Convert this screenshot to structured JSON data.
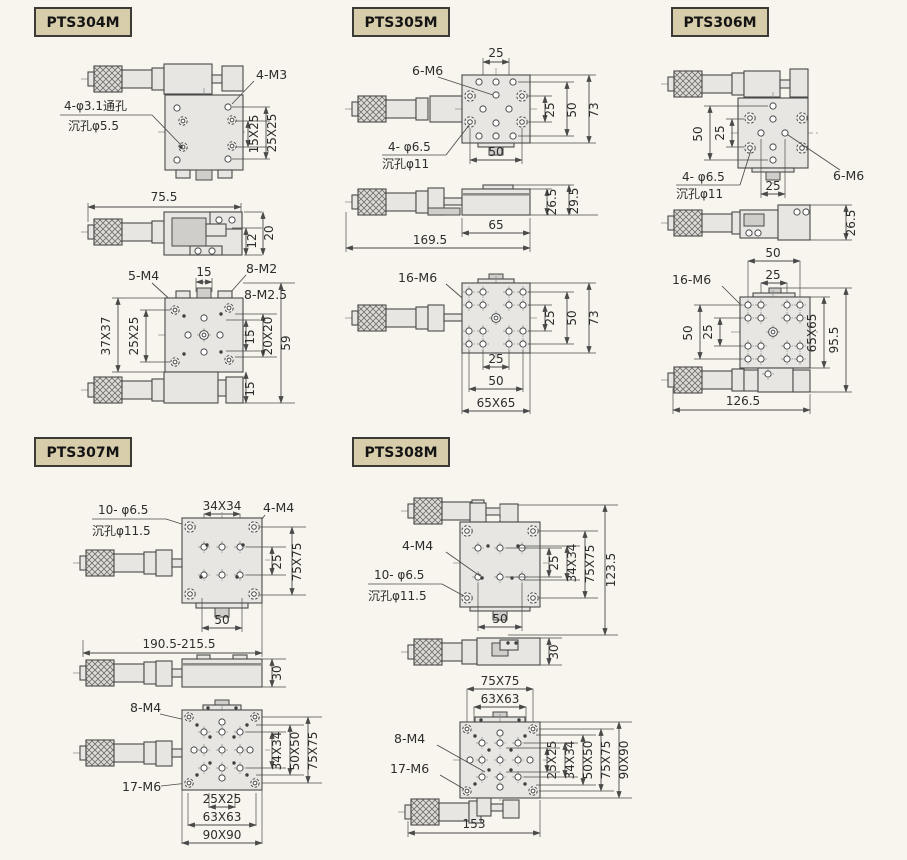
{
  "colors": {
    "background": "#f8f5ee",
    "label_box_bg": "#d8cdab",
    "label_box_border": "#3c3a35",
    "line": "#4a4a4a",
    "metal_fill": "#e7e6e2",
    "text": "#2d2d2d"
  },
  "panels": {
    "p304": {
      "label": "PTS304M",
      "t": {
        "m3": "4-M3",
        "thru": "4-φ3.1通孔",
        "cbore": "沉孔φ5.5",
        "s15x25": "15X25",
        "s25x25": "25X25",
        "w755": "75.5",
        "h12": "12",
        "h20": "20",
        "m4": "5-M4",
        "t15": "15",
        "m2": "8-M2",
        "m25": "8-M2.5",
        "s37": "37X37",
        "s25": "25X25",
        "r15": "15",
        "s20": "20X20",
        "h59": "59",
        "b15": "15"
      }
    },
    "p305": {
      "label": "PTS305M",
      "t": {
        "t25": "25",
        "m6": "6-M6",
        "thru": "4- φ6.5",
        "cbore": "沉孔φ11",
        "r25": "25",
        "r50": "50",
        "r73": "73",
        "b50": "50",
        "h265": "26.5",
        "h295": "29.5",
        "w65": "65",
        "w1695": "169.5",
        "m16": "16-M6",
        "r25b": "25",
        "r50b": "50",
        "r73b": "73",
        "b25": "25",
        "b50b": "50",
        "b65": "65X65"
      }
    },
    "p306": {
      "label": "PTS306M",
      "t": {
        "l50": "50",
        "l25": "25",
        "thru": "4- φ6.5",
        "cbore": "沉孔φ11",
        "m6": "6-M6",
        "b25": "25",
        "h265": "26.5",
        "t50": "50",
        "t25": "25",
        "m16": "16-M6",
        "l50b": "50",
        "l25b": "25",
        "r65": "65X65",
        "r955": "95.5",
        "w1265": "126.5"
      }
    },
    "p307": {
      "label": "PTS307M",
      "t": {
        "thru": "10- φ6.5",
        "cbore": "沉孔φ11.5",
        "s34": "34X34",
        "m4": "4-M4",
        "r25": "25",
        "r75": "75X75",
        "b50": "50",
        "w190": "190.5-215.5",
        "h30": "30",
        "m8": "8-M4",
        "m17": "17-M6",
        "r34": "34X34",
        "r50": "50X50",
        "r75b": "75X75",
        "b2525": "25X25",
        "b6363": "63X63",
        "b9090": "90X90"
      }
    },
    "p308": {
      "label": "PTS308M",
      "t": {
        "m4": "4-M4",
        "thru": "10- φ6.5",
        "cbore": "沉孔φ11.5",
        "r25": "25",
        "r34": "34X34",
        "r75": "75X75",
        "r1235": "123.5",
        "b50": "50",
        "h30": "30",
        "t7575": "75X75",
        "t6363": "63X63",
        "m8": "8-M4",
        "m17": "17-M6",
        "r2525": "25X25",
        "r3434": "34X34",
        "r5050": "50X50",
        "r7575": "75X75",
        "r9090": "90X90",
        "b153": "153"
      }
    }
  }
}
